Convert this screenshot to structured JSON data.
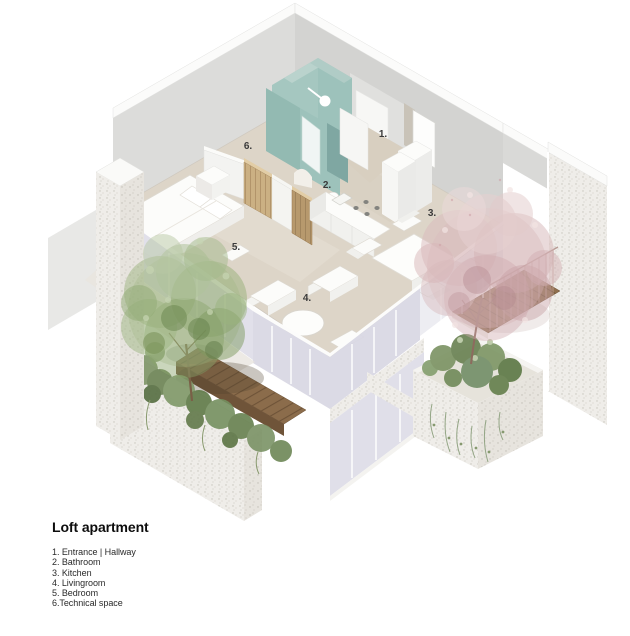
{
  "title": "Loft apartment",
  "legend": {
    "items": [
      "1. Entrance | Hallway",
      "2. Bathroom",
      "3. Kitchen",
      "4. Livingroom",
      "5. Bedroom",
      "6.Technical space"
    ]
  },
  "room_markers": [
    {
      "number": "1."
    },
    {
      "number": "2."
    },
    {
      "number": "3."
    },
    {
      "number": "4."
    },
    {
      "number": "5."
    },
    {
      "number": "6."
    }
  ],
  "colors": {
    "background": "#ffffff",
    "wall_gray": "#d8d8d6",
    "floor_beige": "#ddd5c8",
    "entrance_beige": "#d8cfc0",
    "bathroom_teal": "#9dc2bb",
    "bathroom_teal_dark": "#7fa7a2",
    "wood_cabinet": "#cbb083",
    "deck_wood": "#8b6c4b",
    "glass_lavender": "#d8d7e3",
    "concrete_speckle": "#efede9",
    "tree_green": "#8fa873",
    "tree_pink": "#d9bcbe",
    "shrub_green": "#6d8457",
    "marker_text": "#3a3a3a",
    "legend_text": "#2a2a2a"
  }
}
